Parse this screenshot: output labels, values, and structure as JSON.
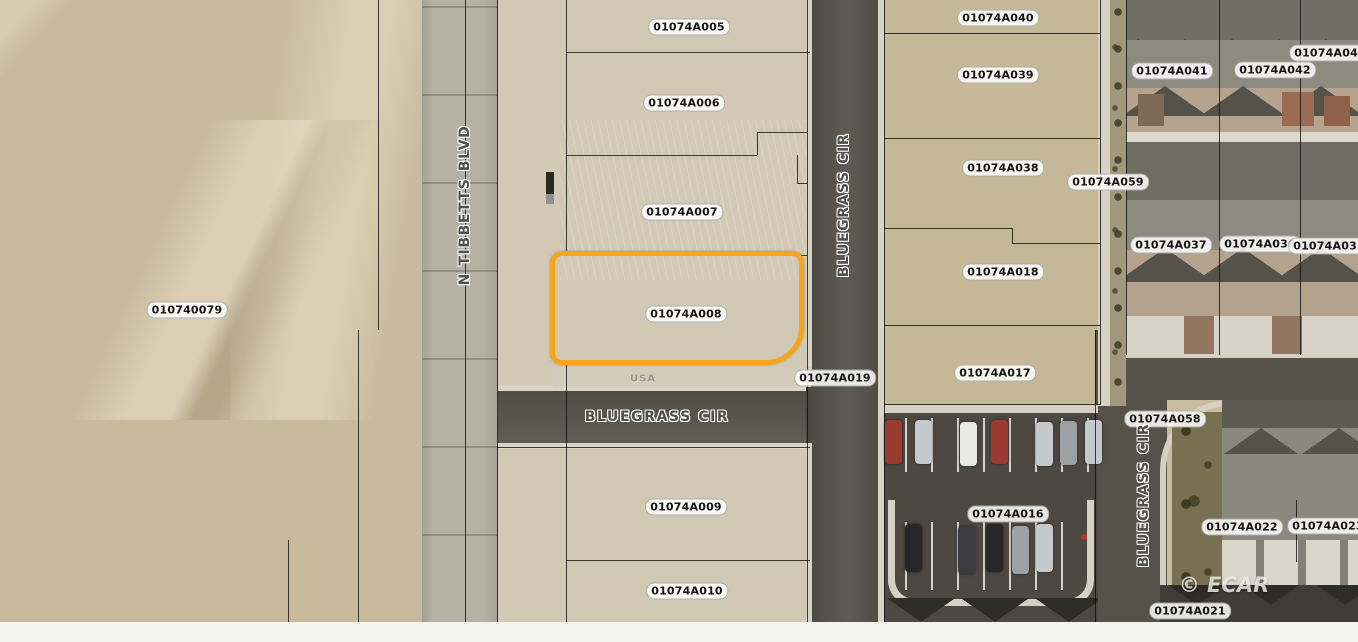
{
  "map": {
    "type": "aerial-parcel-map",
    "highlighted_parcel": {
      "id": "01074A008",
      "outline_color": "#F7A41D"
    },
    "parcel_labels": [
      {
        "id": "01074A005",
        "x": 689,
        "y": 27
      },
      {
        "id": "01074A040",
        "x": 998,
        "y": 18
      },
      {
        "id": "01074A006",
        "x": 684,
        "y": 103
      },
      {
        "id": "01074A039",
        "x": 998,
        "y": 75
      },
      {
        "id": "01074A041",
        "x": 1172,
        "y": 71
      },
      {
        "id": "01074A042",
        "x": 1275,
        "y": 70
      },
      {
        "id": "01074A043",
        "x": 1330,
        "y": 53
      },
      {
        "id": "01074A038",
        "x": 1003,
        "y": 168
      },
      {
        "id": "01074A059",
        "x": 1108,
        "y": 182
      },
      {
        "id": "01074A007",
        "x": 682,
        "y": 212
      },
      {
        "id": "01074A037",
        "x": 1171,
        "y": 245
      },
      {
        "id": "01074A036",
        "x": 1260,
        "y": 244
      },
      {
        "id": "01074A035",
        "x": 1329,
        "y": 246
      },
      {
        "id": "01074A018",
        "x": 1003,
        "y": 272
      },
      {
        "id": "010740079",
        "x": 187,
        "y": 310
      },
      {
        "id": "01074A008",
        "x": 686,
        "y": 314
      },
      {
        "id": "01074A019",
        "x": 835,
        "y": 378
      },
      {
        "id": "01074A017",
        "x": 995,
        "y": 373
      },
      {
        "id": "01074A058",
        "x": 1165,
        "y": 419
      },
      {
        "id": "01074A009",
        "x": 686,
        "y": 507
      },
      {
        "id": "01074A016",
        "x": 1008,
        "y": 514
      },
      {
        "id": "01074A022",
        "x": 1242,
        "y": 527
      },
      {
        "id": "01074A023",
        "x": 1328,
        "y": 526
      },
      {
        "id": "01074A010",
        "x": 687,
        "y": 591
      },
      {
        "id": "01074A021",
        "x": 1190,
        "y": 611
      }
    ],
    "street_labels": [
      {
        "name": "N TIBBETTS BLVD",
        "x": 465,
        "y": 205,
        "rotation": -90
      },
      {
        "name": "BLUEGRASS CIR",
        "x": 844,
        "y": 205,
        "rotation": -90
      },
      {
        "name": "BLUEGRASS CIR",
        "x": 657,
        "y": 417,
        "rotation": 0
      },
      {
        "name": "BLUEGRASS CIR",
        "x": 1144,
        "y": 495,
        "rotation": -90
      }
    ],
    "annotations": [
      {
        "text": "USA",
        "x": 643,
        "y": 379
      }
    ],
    "watermark": {
      "text": "© ECAR"
    },
    "colors": {
      "highlight": "#F7A41D",
      "desert": "#C7BA9D",
      "asphalt": "#56524A",
      "curb": "#D9D4C5",
      "label_text": "#141414",
      "label_background": "#FFFFFF"
    }
  }
}
